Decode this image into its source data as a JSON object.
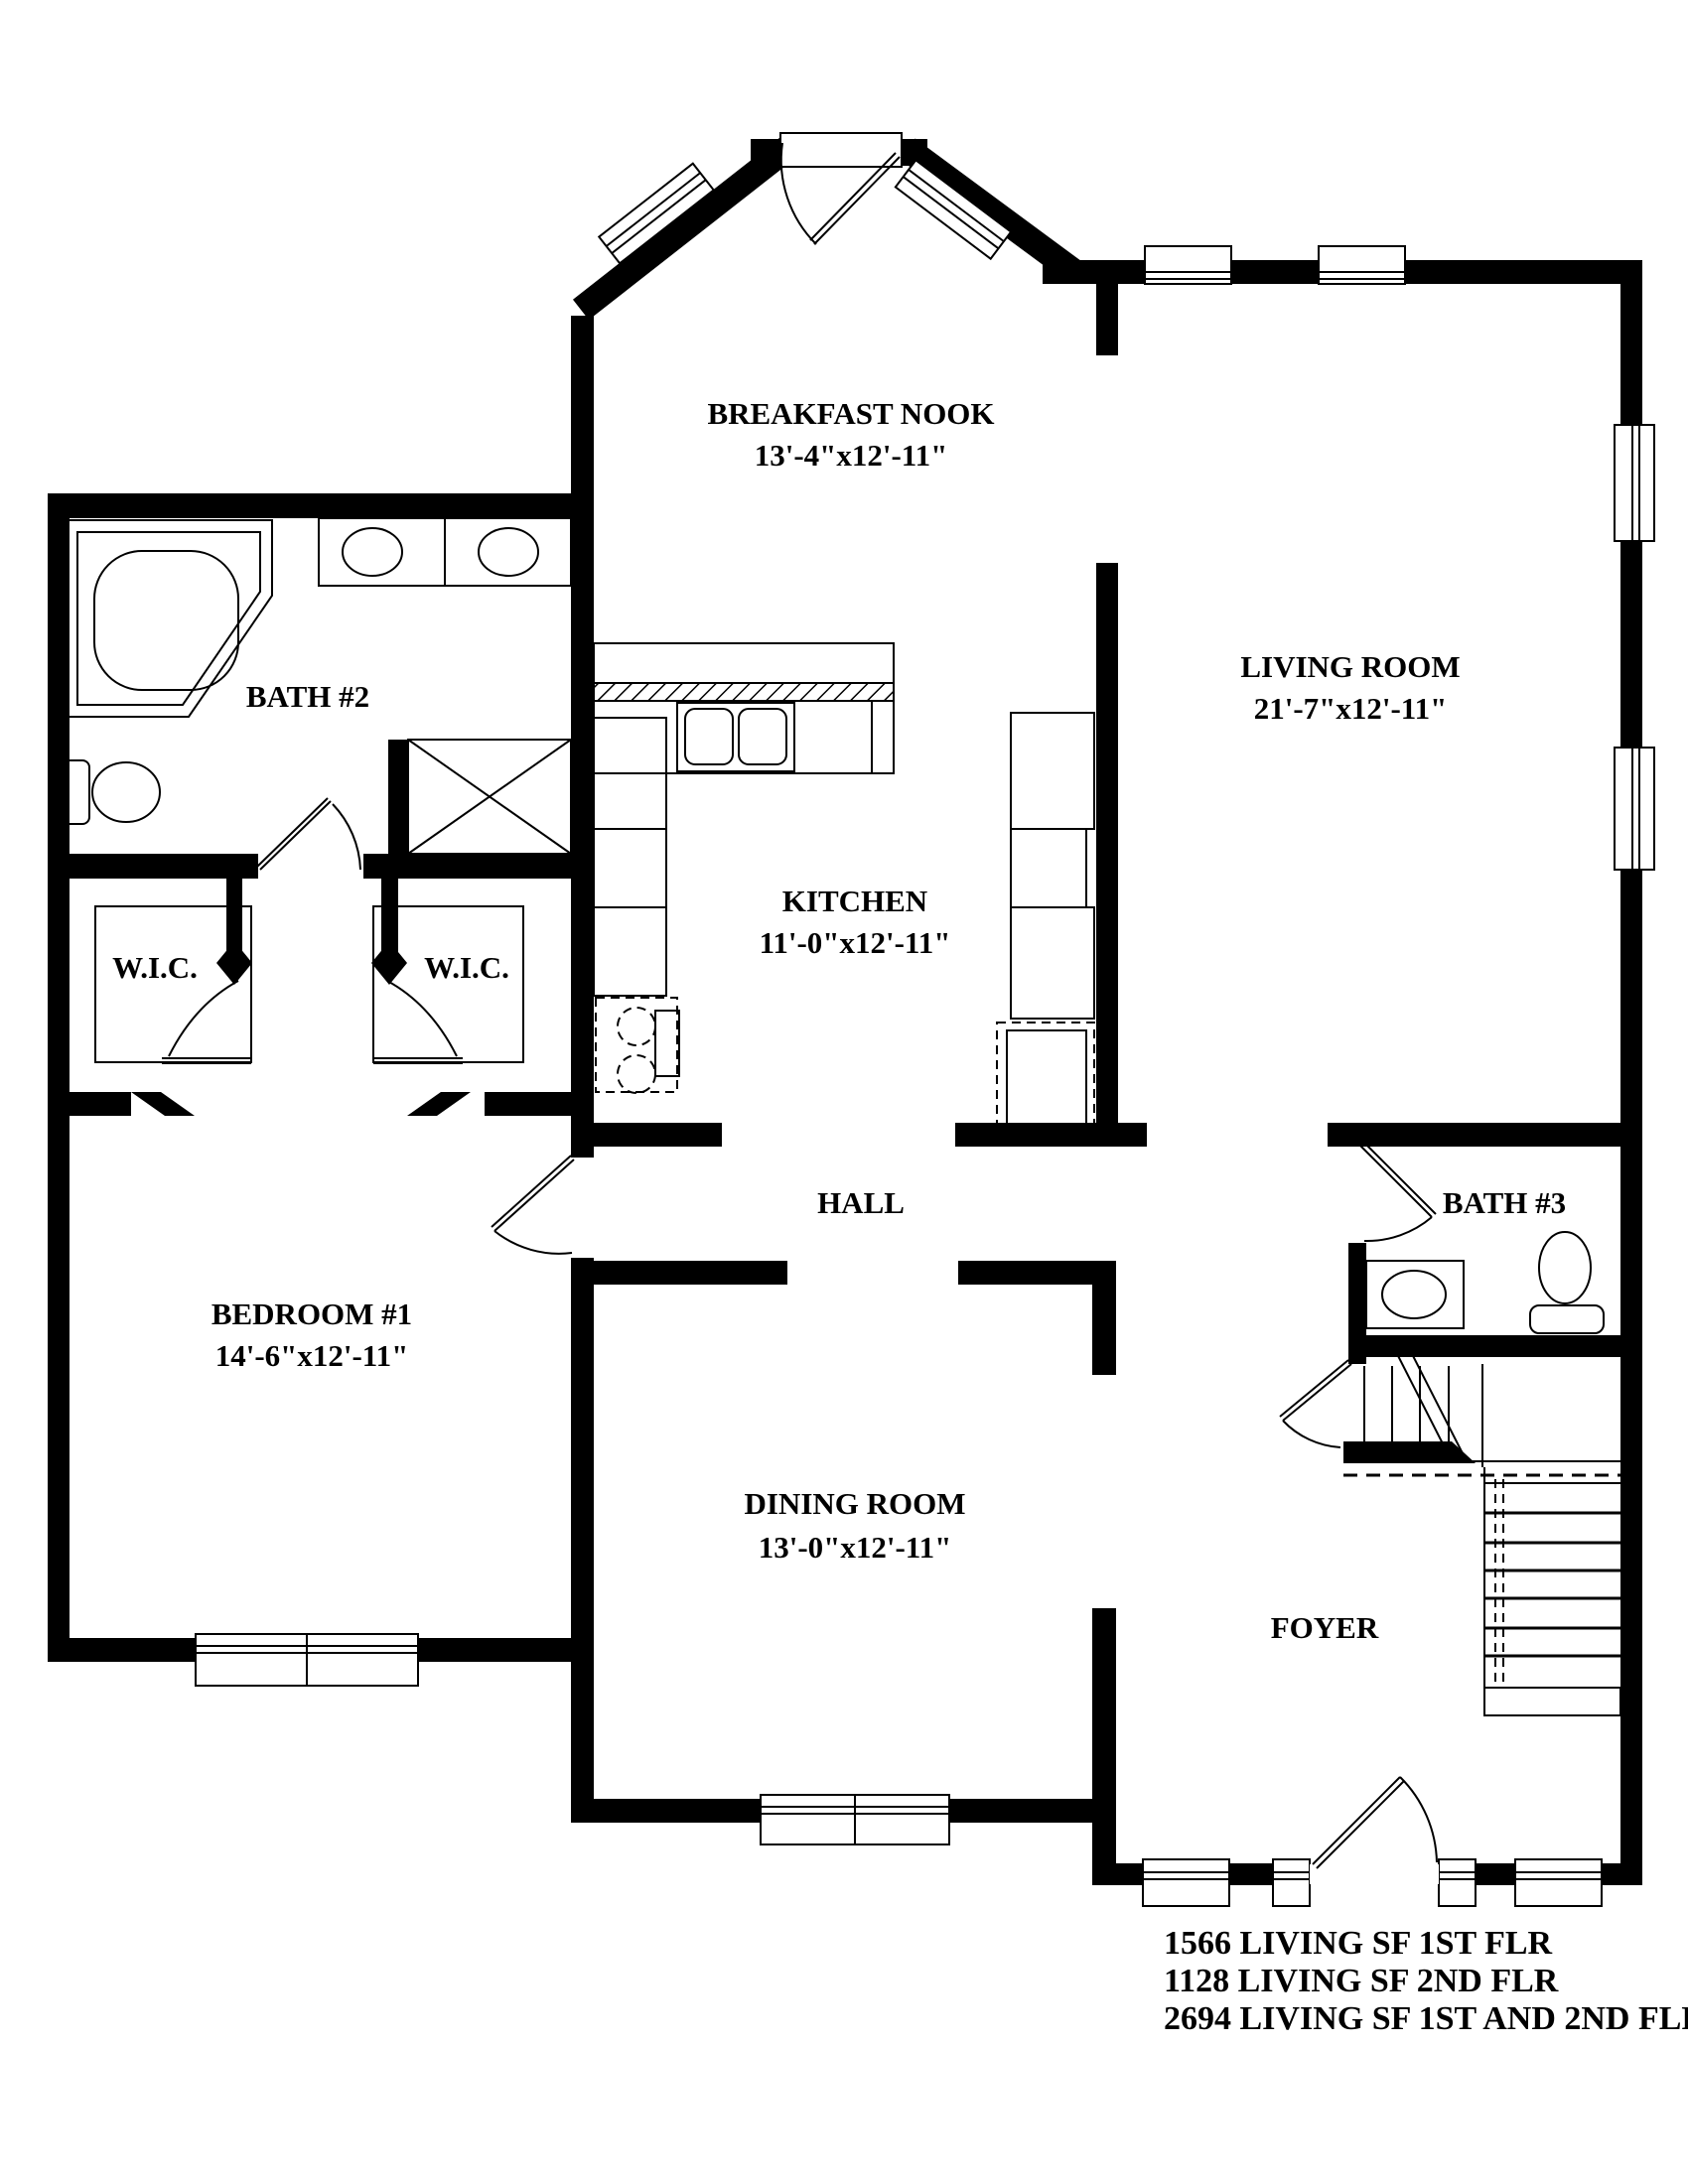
{
  "plan": {
    "title": "First floor plan",
    "rooms": {
      "breakfast_nook": {
        "label": "BREAKFAST NOOK",
        "dims": "13'-4\"x12'-11\""
      },
      "living_room": {
        "label": "LIVING ROOM",
        "dims": "21'-7\"x12'-11\""
      },
      "kitchen": {
        "label": "KITCHEN",
        "dims": "11'-0\"x12'-11\""
      },
      "bath2": {
        "label": "BATH #2"
      },
      "bath3": {
        "label": "BATH #3"
      },
      "wic_left": {
        "label": "W.I.C."
      },
      "wic_right": {
        "label": "W.I.C."
      },
      "hall": {
        "label": "HALL"
      },
      "bedroom1": {
        "label": "BEDROOM #1",
        "dims": "14'-6\"x12'-11\""
      },
      "dining_room": {
        "label": "DINING ROOM",
        "dims": "13'-0\"x12'-11\""
      },
      "foyer": {
        "label": "FOYER"
      }
    },
    "area_summary": {
      "line1": "1566 LIVING SF 1ST FLR",
      "line2": "1128 LIVING SF 2ND FLR",
      "line3": "2694 LIVING SF 1ST AND 2ND FLR"
    },
    "colors": {
      "ink": "#000000",
      "paper": "#ffffff"
    }
  }
}
